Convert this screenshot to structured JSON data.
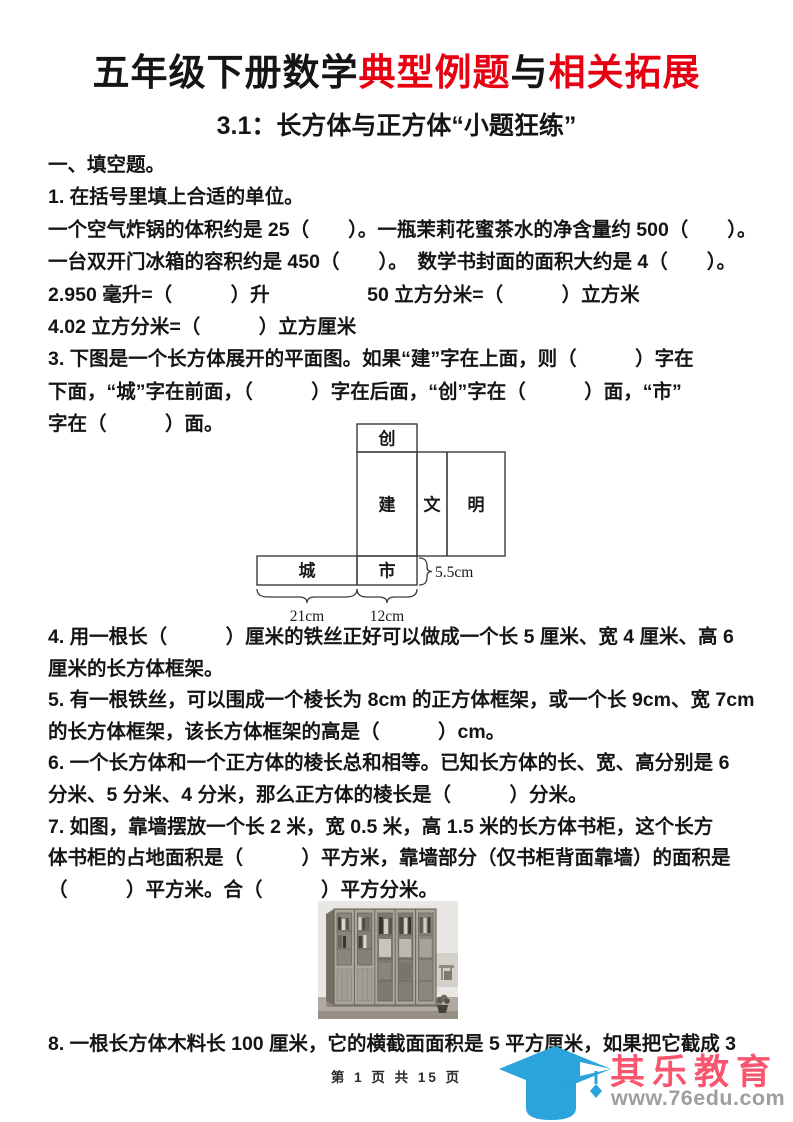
{
  "title": {
    "black1": "五年级下册数学",
    "red1": "典型例题",
    "black2": "与",
    "red2": "相关拓展"
  },
  "subtitle": "3.1：长方体与正方体“小题狂练”",
  "body": {
    "top_lines": [
      "一、填空题。",
      "1. 在括号里填上合适的单位。",
      "一个空气炸锅的体积约是 25（　　）。一瓶茉莉花蜜茶水的净含量约 500（　　）。",
      "一台双开门冰箱的容积约是 450（　　）。　数学书封面的面积大约是 4（　　）。",
      "2.950 毫升=（　　　）升　　　　　50 立方分米=（　　　）立方米",
      "4.02 立方分米=（　　　）立方厘米",
      "3. 下图是一个长方体展开的平面图。如果“建”字在上面，则（　　　）字在",
      "下面，“城”字在前面，（　　　）字在后面，“创”字在（　　　）面，“市”",
      "字在（　　　）面。"
    ],
    "mid_lines": [
      "4. 用一根长（　　　）厘米的铁丝正好可以做成一个长 5 厘米、宽 4 厘米、高 6",
      "厘米的长方体框架。",
      "5. 有一根铁丝，可以围成一个棱长为 8cm 的正方体框架，或一个长 9cm、宽 7cm",
      "的长方体框架，该长方体框架的高是（　　　）cm。",
      "6. 一个长方体和一个正方体的棱长总和相等。已知长方体的长、宽、高分别是 6",
      "分米、5 分米、4 分米，那么正方体的棱长是（　　　）分米。",
      "7. 如图，靠墙摆放一个长 2 米，宽 0.5 米，高 1.5 米的长方体书柜，这个长方",
      "体书柜的占地面积是（　　　）平方米，靠墙部分（仅书柜背面靠墙）的面积是",
      "（　　　）平方米。合（　　　）平方分米。"
    ],
    "q8_line": "8. 一根长方体木料长 100 厘米，它的横截面面积是 5 平方厘米，如果把它截成 3"
  },
  "diagram": {
    "faces": {
      "top_flap": "创",
      "front": "建",
      "side": "文",
      "back": "明",
      "left": "城",
      "bottom": "市"
    },
    "dims": {
      "length": "21cm",
      "width": "12cm",
      "height": "5.5cm"
    }
  },
  "footer": {
    "page_info": "第 1 页 共 15 页"
  },
  "logo": {
    "name": "其乐教育",
    "url": "www.76edu.com"
  },
  "colors": {
    "accent_red": "#e60012",
    "logo_blue": "#2ba3db",
    "logo_pink": "#f8566f",
    "logo_gray": "#9e9e9e"
  }
}
